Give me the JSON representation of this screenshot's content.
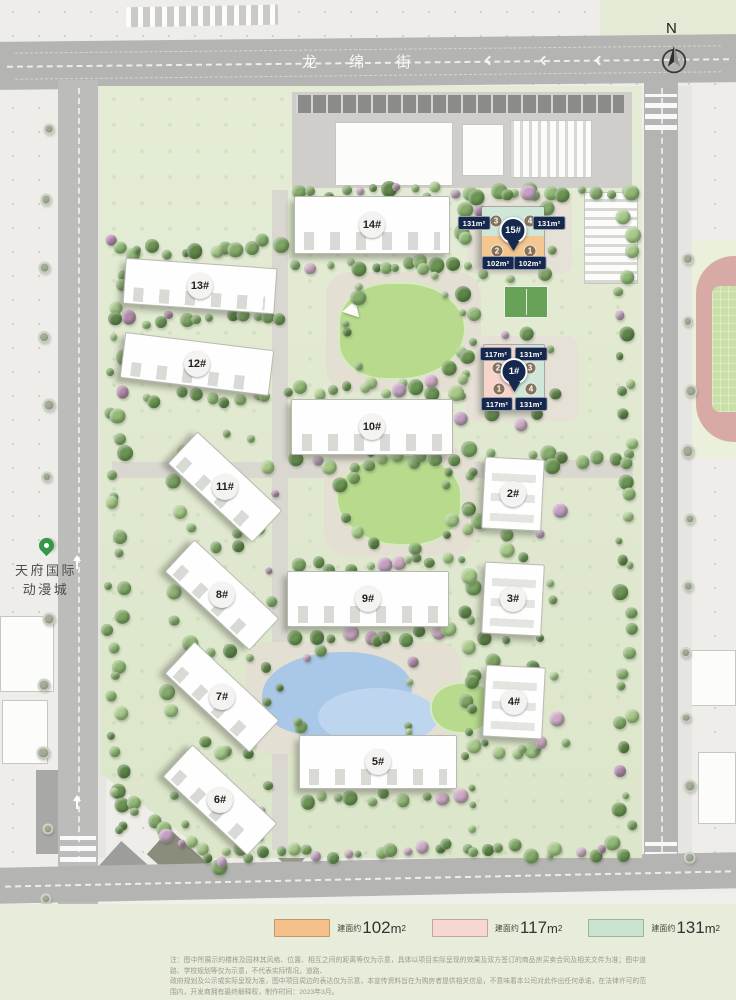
{
  "street": {
    "name": "龙绵街"
  },
  "compass": {
    "label": "N"
  },
  "landmark": {
    "line1": "天府国际",
    "line2": "动漫城"
  },
  "buildings": [
    {
      "label": "14#",
      "cx": 372,
      "cy": 225,
      "w": 156,
      "h": 58,
      "rot": 0
    },
    {
      "label": "13#",
      "cx": 200,
      "cy": 286,
      "w": 152,
      "h": 46,
      "rot": 4
    },
    {
      "label": "12#",
      "cx": 197,
      "cy": 364,
      "w": 150,
      "h": 46,
      "rot": 7
    },
    {
      "label": "10#",
      "cx": 372,
      "cy": 427,
      "w": 162,
      "h": 56,
      "rot": 0
    },
    {
      "label": "11#",
      "cx": 225,
      "cy": 487,
      "w": 116,
      "h": 44,
      "rot": 43
    },
    {
      "label": "2#",
      "cx": 513,
      "cy": 494,
      "w": 60,
      "h": 72,
      "rot": 3
    },
    {
      "label": "8#",
      "cx": 222,
      "cy": 595,
      "w": 116,
      "h": 44,
      "rot": 43
    },
    {
      "label": "9#",
      "cx": 368,
      "cy": 599,
      "w": 162,
      "h": 56,
      "rot": 0
    },
    {
      "label": "3#",
      "cx": 513,
      "cy": 599,
      "w": 60,
      "h": 72,
      "rot": 3
    },
    {
      "label": "7#",
      "cx": 222,
      "cy": 697,
      "w": 116,
      "h": 44,
      "rot": 43
    },
    {
      "label": "4#",
      "cx": 514,
      "cy": 702,
      "w": 60,
      "h": 72,
      "rot": 3
    },
    {
      "label": "5#",
      "cx": 378,
      "cy": 762,
      "w": 158,
      "h": 54,
      "rot": 0
    },
    {
      "label": "6#",
      "cx": 220,
      "cy": 800,
      "w": 116,
      "h": 44,
      "rot": 43
    }
  ],
  "special_buildings": [
    {
      "pin": "15#",
      "cx": 513,
      "cy": 236,
      "w": 64,
      "h": 60,
      "split": "h",
      "half_colors": [
        "#cfe7d8",
        "#f4c791"
      ],
      "pin_x": 513,
      "pin_y": 251,
      "units": [
        {
          "n": "3",
          "x": 496,
          "y": 221
        },
        {
          "n": "4",
          "x": 530,
          "y": 221
        },
        {
          "n": "2",
          "x": 497,
          "y": 251
        },
        {
          "n": "1",
          "x": 530,
          "y": 251
        }
      ],
      "chips": [
        {
          "text": "131m²",
          "x": 474,
          "y": 223
        },
        {
          "text": "131m²",
          "x": 549,
          "y": 223
        },
        {
          "text": "102m²",
          "x": 498,
          "y": 263
        },
        {
          "text": "102m²",
          "x": 530,
          "y": 263
        }
      ]
    },
    {
      "pin": "1#",
      "cx": 514,
      "cy": 377,
      "w": 62,
      "h": 66,
      "split": "v",
      "half_colors": [
        "#f8d3c9",
        "#cfe7d8"
      ],
      "pin_x": 514,
      "pin_y": 392,
      "units": [
        {
          "n": "2",
          "x": 498,
          "y": 368
        },
        {
          "n": "3",
          "x": 530,
          "y": 368
        },
        {
          "n": "1",
          "x": 499,
          "y": 389
        },
        {
          "n": "4",
          "x": 531,
          "y": 389
        }
      ],
      "chips": [
        {
          "text": "117m²",
          "x": 496,
          "y": 354
        },
        {
          "text": "131m²",
          "x": 531,
          "y": 354
        },
        {
          "text": "117m²",
          "x": 497,
          "y": 404
        },
        {
          "text": "131m²",
          "x": 531,
          "y": 404
        }
      ]
    }
  ],
  "legend": {
    "items": [
      {
        "swatch": "#f4c18a",
        "prefix": "建面约",
        "value": "102",
        "unit": "m",
        "sup": "2"
      },
      {
        "swatch": "#f9d7d1",
        "prefix": "建面约",
        "value": "117",
        "unit": "m",
        "sup": "2"
      },
      {
        "swatch": "#c9e4cf",
        "prefix": "建面约",
        "value": "131",
        "unit": "m",
        "sup": "2"
      }
    ]
  },
  "disclaimer": {
    "line1": "注：图中所展示的楼栋及园林其风格、位置、相互之间的距离等仅为示意，具体以项目实际呈现的效果及双方签订的商品房买卖合同及相关文件为准；图中道路、学校规划等仅为示意，不代表实际情况，道路、",
    "line2": "政府规划及公示或实际呈现为准，图中项目周边的表达仅为示意，本宣传资料旨在为购房者提供相关信息，不意味着本公司对此作出任何承诺，在法律许可的范围内，开发商拥有最终解释权，制作时间：2023年3月。"
  }
}
